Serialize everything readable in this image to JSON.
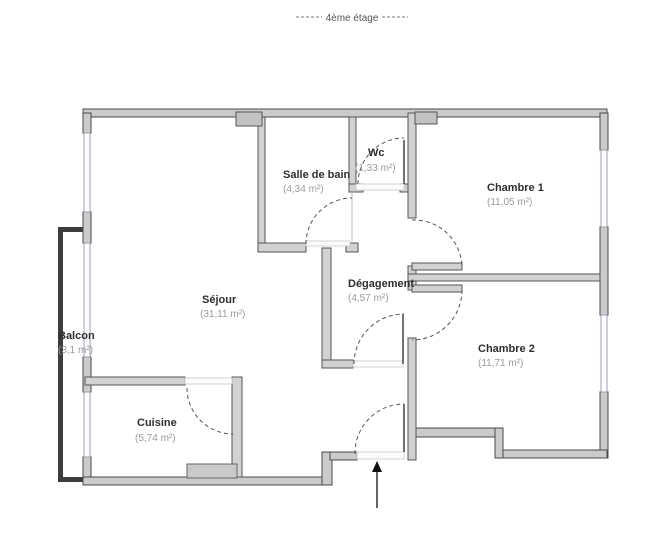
{
  "title": {
    "floor_label": "4ème étage"
  },
  "rooms": {
    "salle_de_bain": {
      "name": "Salle de bain",
      "area": "(4,34 m²)"
    },
    "wc": {
      "name": "Wc",
      "area": "(1,33 m²)"
    },
    "chambre1": {
      "name": "Chambre 1",
      "area": "(11,05 m²)"
    },
    "sejour": {
      "name": "Séjour",
      "area": "(31,11 m²)"
    },
    "degagement": {
      "name": "Dégagement",
      "area": "(4,57 m²)"
    },
    "chambre2": {
      "name": "Chambre 2",
      "area": "(11,71 m²)"
    },
    "balcon": {
      "name": "Balcon",
      "area": "(3,1 m²)"
    },
    "cuisine": {
      "name": "Cuisine",
      "area": "(5,74 m²)"
    }
  },
  "colors": {
    "wall_exterior": "#cbcbcb",
    "wall_interior": "#d2d2d2",
    "wall_outline": "#4a4a4a",
    "balcony_line": "#3d3d3d",
    "room_name_text": "#2e2e2e",
    "room_area_text": "#9b9b9b",
    "door_arc": "#555555",
    "background": "#ffffff"
  }
}
